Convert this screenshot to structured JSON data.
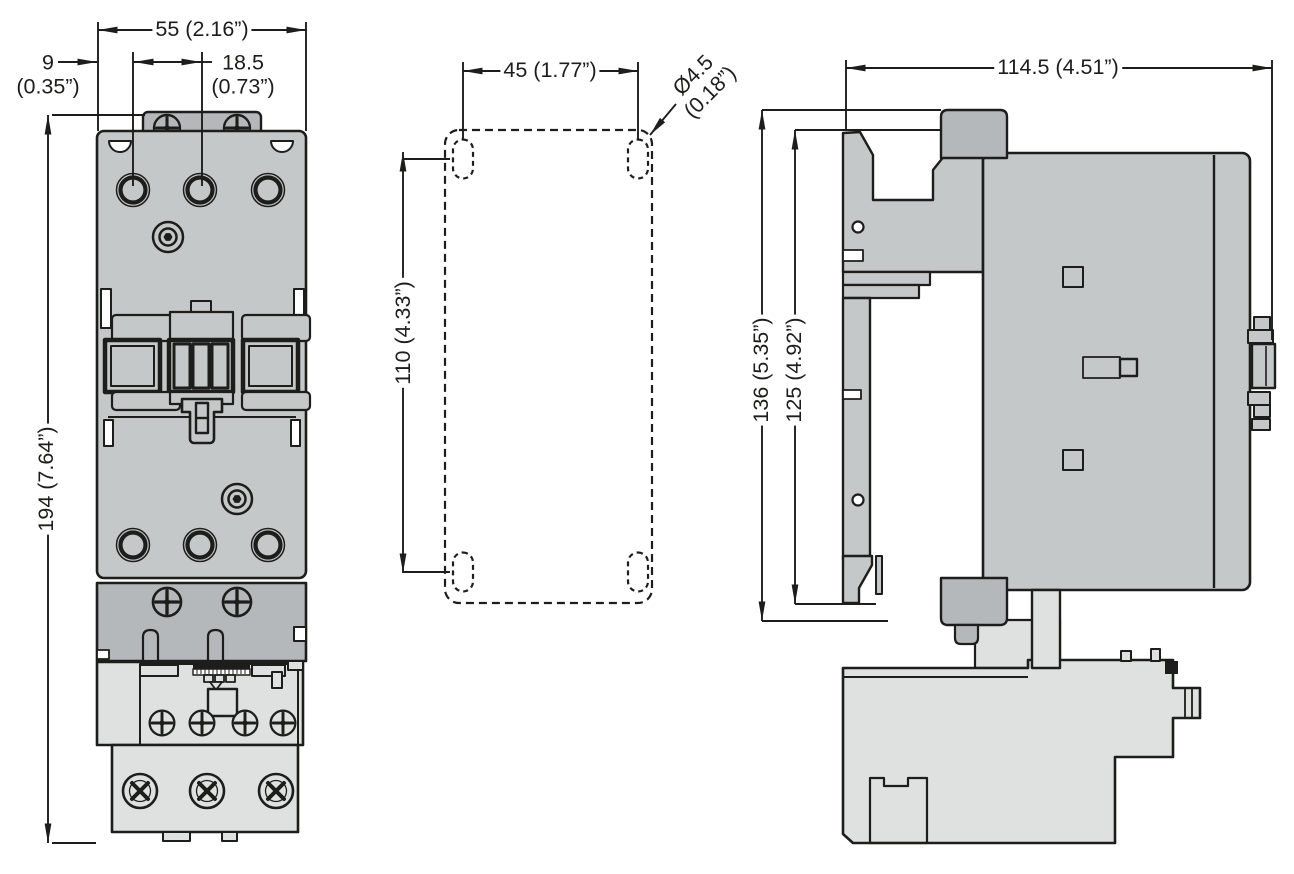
{
  "colors": {
    "line": "#1d1d1b",
    "body_gray": "#c5c8c9",
    "dark_gray": "#b5b8ba",
    "light_gray": "#dfe1e1",
    "background": "#ffffff"
  },
  "dims": {
    "front_width": "55 (2.16”)",
    "front_edge_to_first_hole": "9",
    "front_edge_to_first_hole_inches": "(0.35”)",
    "front_hole_pitch": "18.5",
    "front_hole_pitch_inches": "(0.73”)",
    "front_height": "194 (7.64”)",
    "mount_hole_spacing_horizontal": "45 (1.77”)",
    "mount_hole_diameter": "Ø4.5",
    "mount_hole_diameter_inches": "(0.18”)",
    "mount_hole_spacing_vertical": "110 (4.33”)",
    "side_depth": "114.5 (4.51”)",
    "side_height_overall": "136 (5.35”)",
    "side_height_body": "125 (4.92”)"
  }
}
